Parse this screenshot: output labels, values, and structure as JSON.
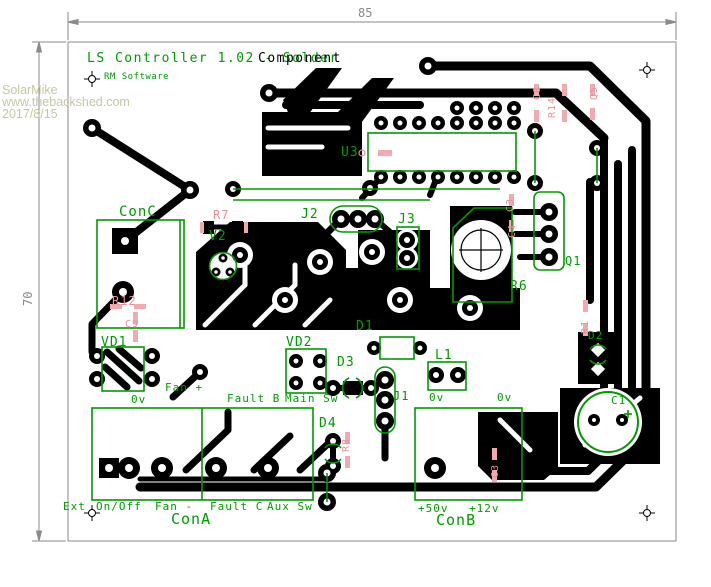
{
  "title_block": {
    "layer_solder": "LS Controller 1.02 - Solder",
    "layer_component": "Component",
    "software": "RM Software"
  },
  "watermark": {
    "lines": [
      "SolarMike",
      "www.thebackshed.com",
      "2017/8/15"
    ]
  },
  "board_dimensions": {
    "width": "85",
    "height": "70"
  },
  "colors": {
    "silkscreen": "#009a00",
    "ref": "#e89098",
    "copper": "#000000",
    "watermark": "#c6c6a4",
    "dimension": "#8a8a8a",
    "padpink": "#f2aab0"
  },
  "silkscreen_labels": [
    {
      "text": "ConC",
      "x": 119,
      "y": 205,
      "size": 14
    },
    {
      "text": "V2",
      "x": 209,
      "y": 230,
      "size": 13
    },
    {
      "text": "U3",
      "x": 341,
      "y": 146,
      "size": 13
    },
    {
      "text": "J2",
      "x": 301,
      "y": 208,
      "size": 13
    },
    {
      "text": "J3",
      "x": 398,
      "y": 213,
      "size": 13
    },
    {
      "text": "Q1",
      "x": 565,
      "y": 255,
      "size": 12
    },
    {
      "text": "R6",
      "x": 510,
      "y": 280,
      "size": 13
    },
    {
      "text": "VD1",
      "x": 101,
      "y": 336,
      "size": 13
    },
    {
      "text": "Fan +",
      "x": 165,
      "y": 382,
      "size": 11
    },
    {
      "text": "0v",
      "x": 131,
      "y": 394,
      "size": 11
    },
    {
      "text": "Fault B",
      "x": 227,
      "y": 393,
      "size": 11
    },
    {
      "text": "Main Sw",
      "x": 285,
      "y": 393,
      "size": 11
    },
    {
      "text": "VD2",
      "x": 286,
      "y": 336,
      "size": 13
    },
    {
      "text": "D3",
      "x": 337,
      "y": 356,
      "size": 13
    },
    {
      "text": "D1",
      "x": 356,
      "y": 320,
      "size": 13
    },
    {
      "text": "J1",
      "x": 393,
      "y": 390,
      "size": 12
    },
    {
      "text": "0v",
      "x": 429,
      "y": 392,
      "size": 11
    },
    {
      "text": "0v",
      "x": 497,
      "y": 392,
      "size": 11
    },
    {
      "text": "D4",
      "x": 319,
      "y": 417,
      "size": 13
    },
    {
      "text": "L1",
      "x": 435,
      "y": 349,
      "size": 13
    },
    {
      "text": "D2",
      "x": 588,
      "y": 330,
      "size": 11
    },
    {
      "text": "C1",
      "x": 611,
      "y": 395,
      "size": 11
    },
    {
      "text": "Ext",
      "x": 63,
      "y": 501,
      "size": 11
    },
    {
      "text": "On/Off",
      "x": 96,
      "y": 501,
      "size": 11
    },
    {
      "text": "Fan -",
      "x": 155,
      "y": 501,
      "size": 11
    },
    {
      "text": "Fault C",
      "x": 210,
      "y": 501,
      "size": 11
    },
    {
      "text": "Aux Sw",
      "x": 267,
      "y": 501,
      "size": 11
    },
    {
      "text": "ConA",
      "x": 171,
      "y": 512,
      "size": 15
    },
    {
      "text": "+50v",
      "x": 418,
      "y": 503,
      "size": 11
    },
    {
      "text": "+12v",
      "x": 469,
      "y": 503,
      "size": 11
    },
    {
      "text": "ConB",
      "x": 436,
      "y": 513,
      "size": 15
    }
  ],
  "ref_labels": [
    {
      "text": "R7",
      "x": 213,
      "y": 209,
      "size": 12
    },
    {
      "text": "R12",
      "x": 112,
      "y": 295,
      "size": 12
    },
    {
      "text": "C9",
      "x": 125,
      "y": 320,
      "size": 10
    },
    {
      "text": "C8",
      "x": 533,
      "y": 100,
      "size": 10,
      "rot": 1
    },
    {
      "text": "R14",
      "x": 548,
      "y": 118,
      "size": 10,
      "rot": 1
    },
    {
      "text": "Q5",
      "x": 590,
      "y": 100,
      "size": 10,
      "rot": 1
    },
    {
      "text": "C3",
      "x": 506,
      "y": 212,
      "size": 10,
      "rot": 1
    },
    {
      "text": "C4",
      "x": 508,
      "y": 238,
      "size": 10,
      "rot": 1
    },
    {
      "text": "R8",
      "x": 342,
      "y": 452,
      "size": 10,
      "rot": 1
    },
    {
      "text": "C3",
      "x": 491,
      "y": 478,
      "size": 10,
      "rot": 1
    },
    {
      "text": "R1",
      "x": 581,
      "y": 334,
      "size": 10,
      "rot": 1
    }
  ]
}
